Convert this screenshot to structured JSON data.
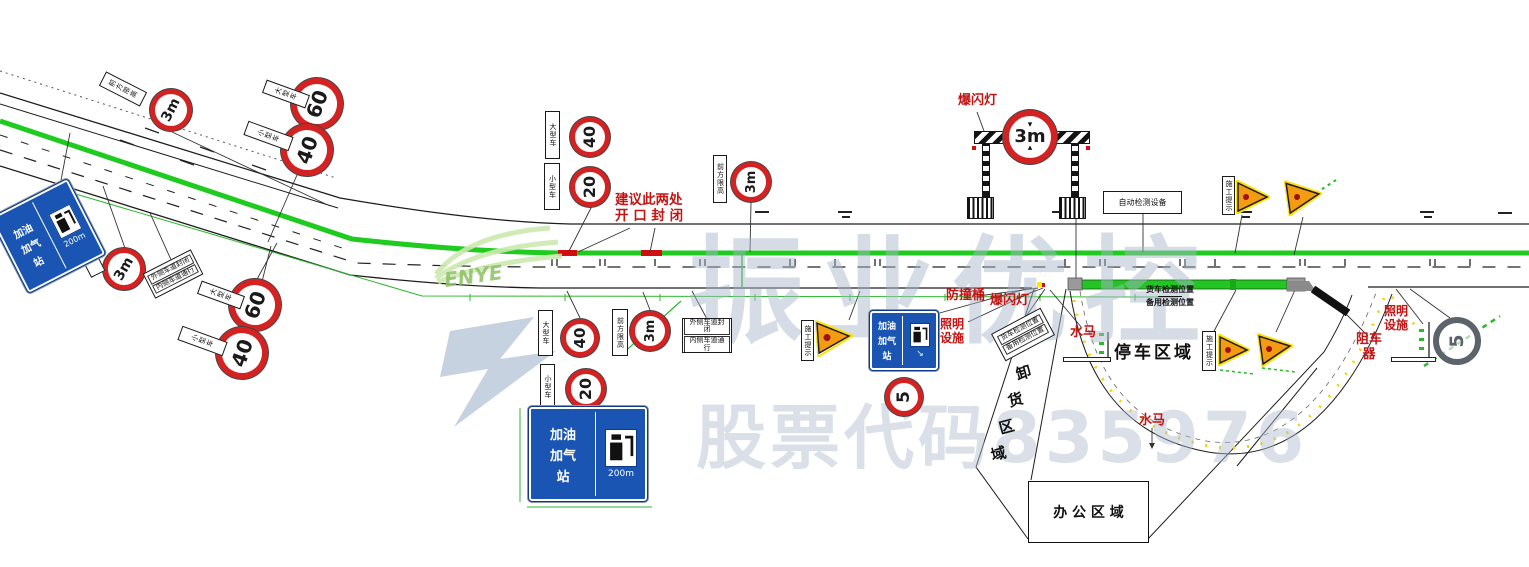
{
  "watermark": {
    "brand": "振业优控",
    "stock_label": "股票代码",
    "stock_code": "835976",
    "logo_text": "ENYE"
  },
  "signs": {
    "limit_3m": "3m",
    "s60": "60",
    "s40": "40",
    "s20": "20",
    "s5": "5"
  },
  "notes": {
    "suggest_1": "建议此两处",
    "suggest_2": "开 口 封 闭",
    "truck_detect": "货车检测位置",
    "backup_detect": "备用检测位置"
  },
  "red_labels": {
    "strobe": "爆闪灯",
    "crash_barrel": "防撞桶",
    "lighting_1": "照明",
    "lighting_2": "设施",
    "water_barrier": "水马",
    "stopper_1": "阻车",
    "stopper_2": "器"
  },
  "areas": {
    "parking": "停车区域",
    "unloading": [
      "卸",
      "货",
      "区",
      "域"
    ],
    "office": "办 公 区 域"
  },
  "plates": {
    "height_ahead": "前方限高",
    "large_vehicle": "大型车",
    "small_vehicle": "小型车",
    "outer_closed": "外侧车道封闭",
    "inner_open": "内侧车道通行",
    "service": "服务区",
    "construction": "施工提示",
    "auto_detect": "自动检测设备"
  },
  "blue_sign": {
    "line1": "加油",
    "line2": "加气",
    "line3": "站",
    "distance": "200m",
    "arrow": "↘"
  }
}
